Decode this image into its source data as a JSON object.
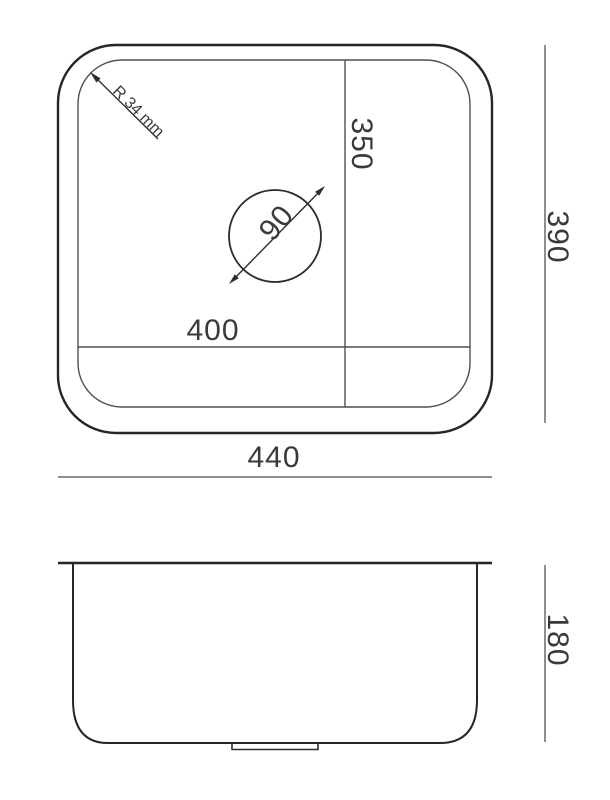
{
  "drawing": {
    "type": "sink-technical-drawing",
    "labels": {
      "corner_radius": "R 34 mm",
      "bowl_width": "350",
      "drain_diameter": "90",
      "bowl_length": "400",
      "overall_length": "440",
      "overall_width": "390",
      "depth": "180"
    },
    "colors": {
      "outline": "#262626",
      "inner_line": "#4f4f4f",
      "dimension_line": "#8f8f8f",
      "text": "#3a3a3a",
      "background": "#ffffff"
    }
  }
}
